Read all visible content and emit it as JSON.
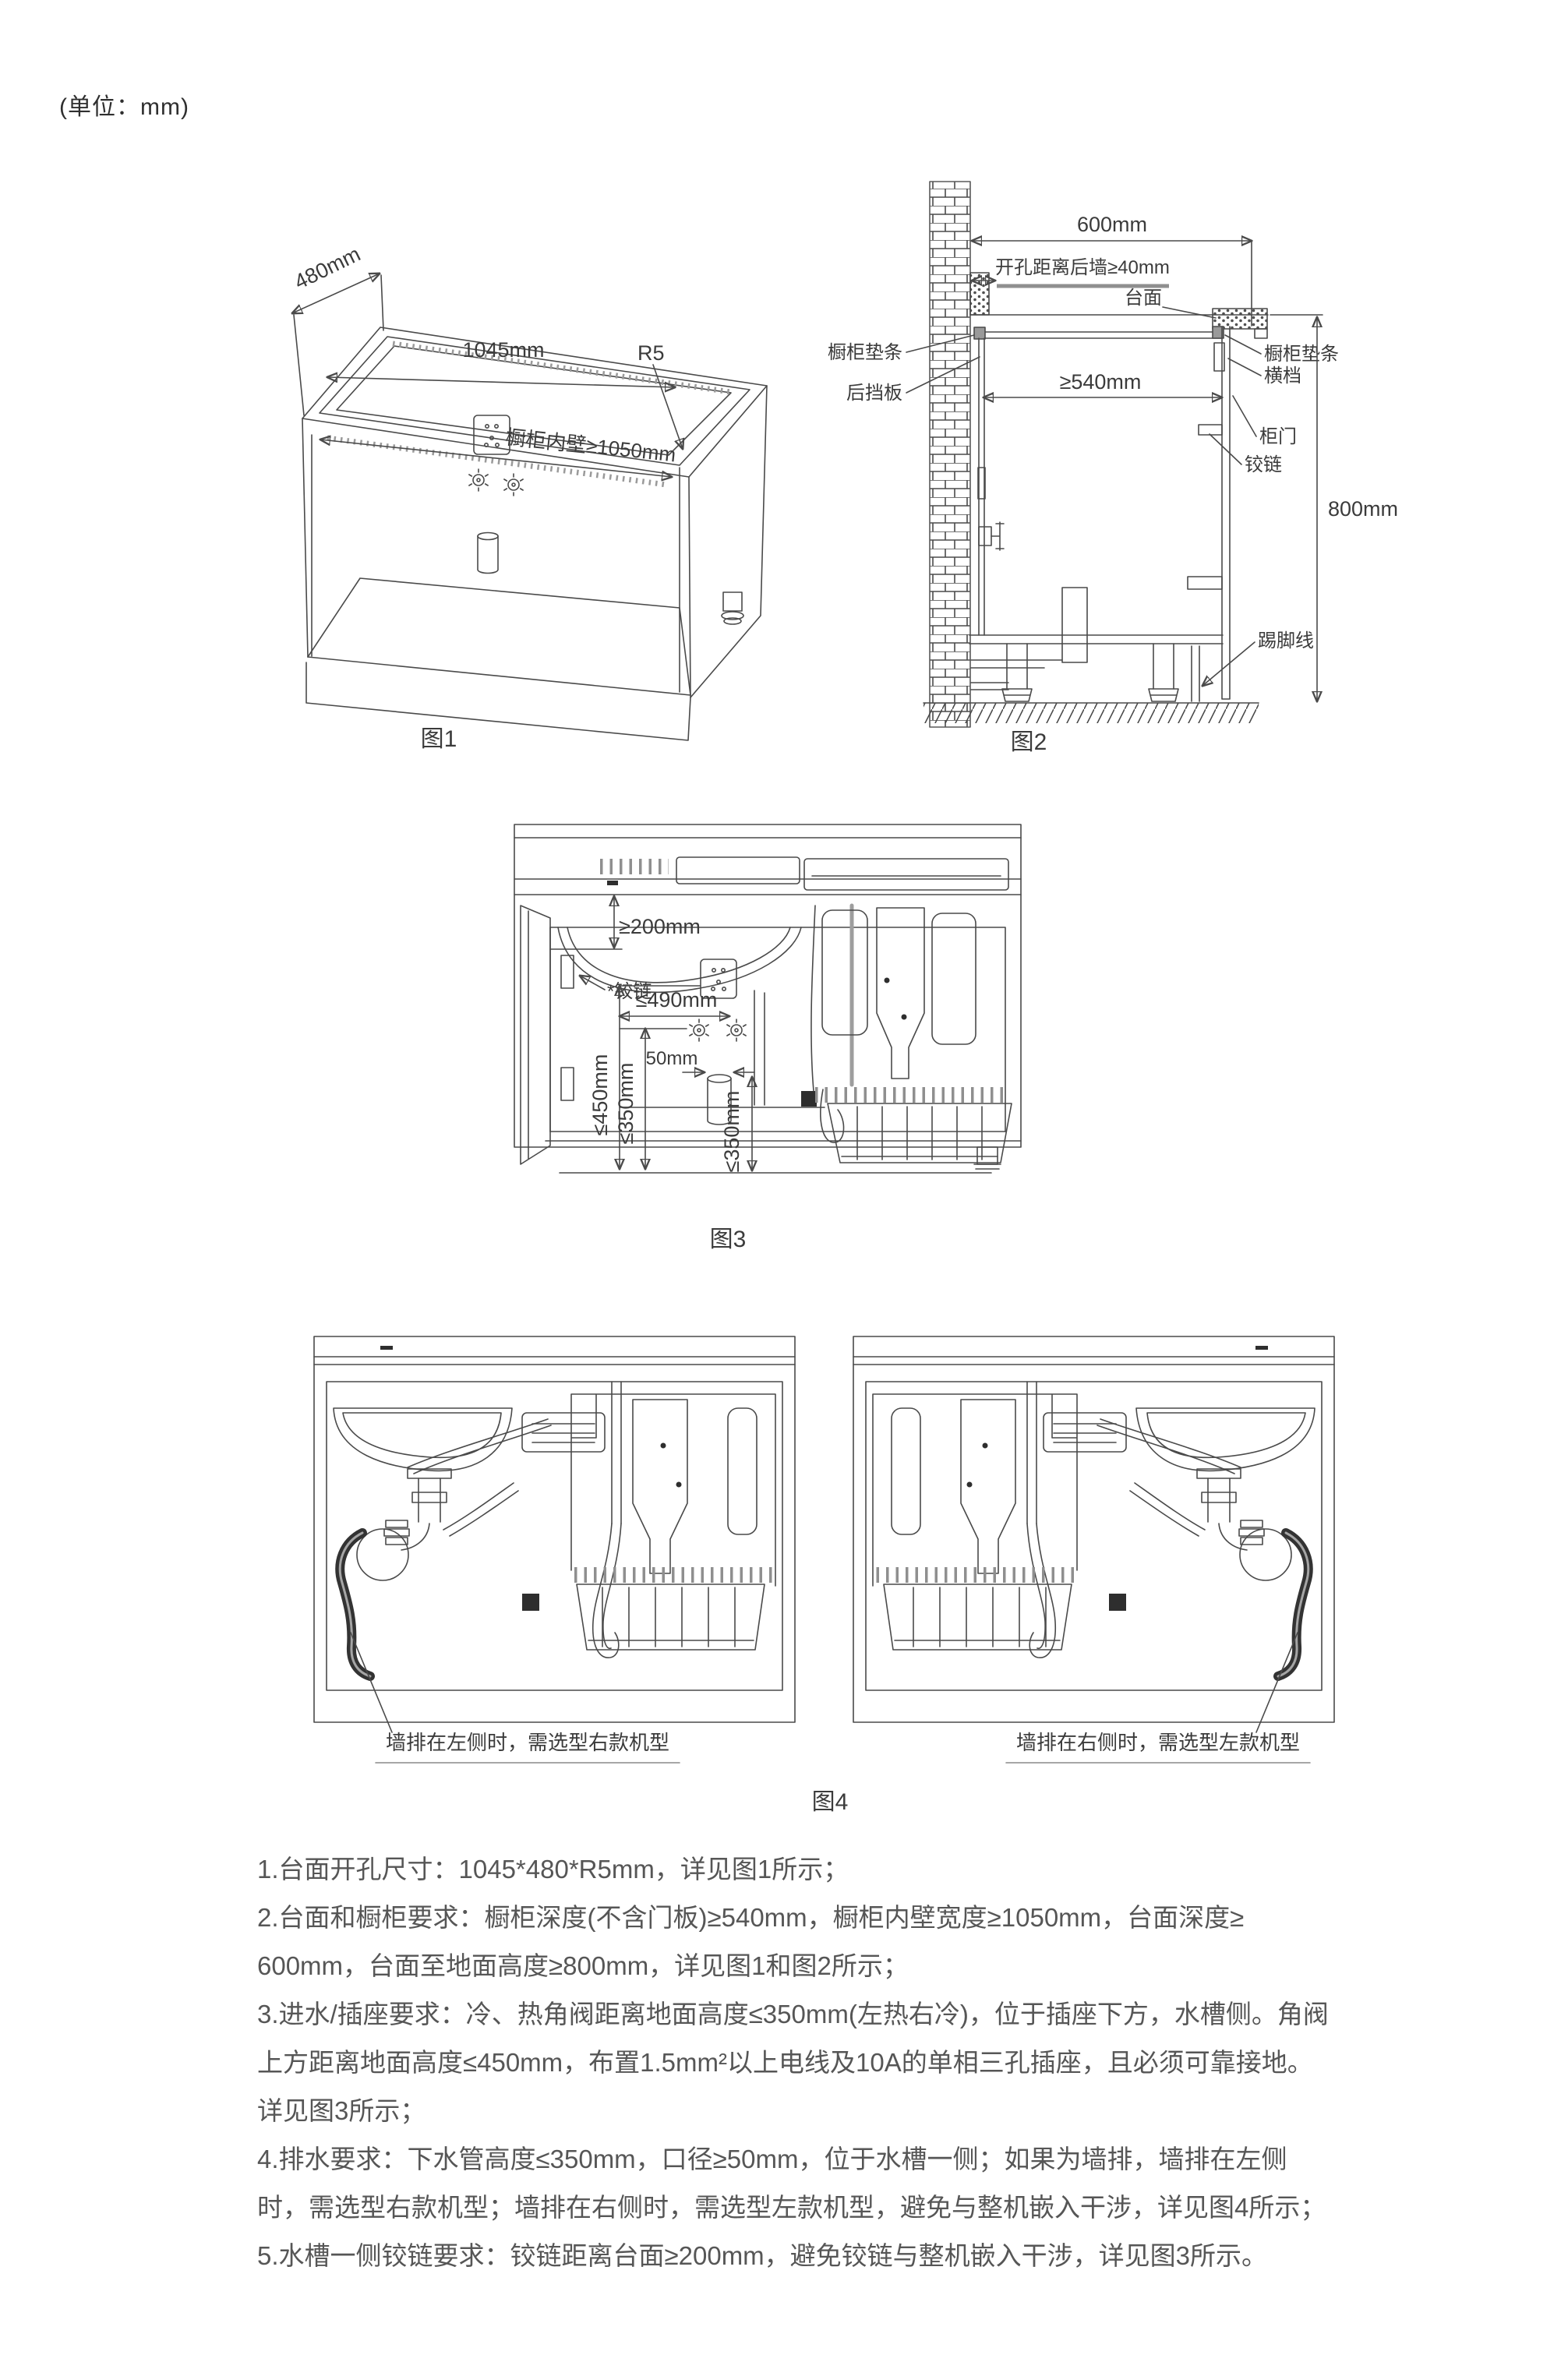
{
  "page": {
    "unit_note": "(单位：mm)"
  },
  "fig1": {
    "caption": "图1",
    "labels": {
      "depth": "480mm",
      "width": "1045mm",
      "radius": "R5",
      "inner_wall": "橱柜内壁≥1050mm"
    }
  },
  "fig2": {
    "caption": "图2",
    "labels": {
      "top_width": "600mm",
      "hole_to_wall": "开孔距离后墙≥40mm",
      "countertop": "台面",
      "pad_left": "橱柜垫条",
      "back_board": "后挡板",
      "inner_depth": "≥540mm",
      "pad_right": "橱柜垫条",
      "cross_rail": "横档",
      "door": "柜门",
      "hinge": "铰链",
      "height": "800mm",
      "kick_line": "踢脚线"
    }
  },
  "fig3": {
    "caption": "图3",
    "labels": {
      "hinge_gap": "≥200mm",
      "hinge": "*铰链",
      "valve_width": "≤490mm",
      "pipe_width": "50mm",
      "valve_top_height": "≤450mm",
      "valve_height": "≤350mm",
      "drain_height": "≤350mm"
    }
  },
  "fig4": {
    "caption": "图4",
    "left_caption": "墙排在左侧时，需选型右款机型",
    "right_caption": "墙排在右侧时，需选型左款机型"
  },
  "notes": {
    "lines": [
      "1.台面开孔尺寸：1045*480*R5mm，详见图1所示；",
      "2.台面和橱柜要求：橱柜深度(不含门板)≥540mm，橱柜内壁宽度≥1050mm，台面深度≥",
      "600mm，台面至地面高度≥800mm，详见图1和图2所示；",
      "3.进水/插座要求：冷、热角阀距离地面高度≤350mm(左热右冷)，位于插座下方，水槽侧。角阀",
      "上方距离地面高度≤450mm，布置1.5mm²以上电线及10A的单相三孔插座，且必须可靠接地。",
      "详见图3所示；",
      "4.排水要求：下水管高度≤350mm，口径≥50mm，位于水槽一侧；如果为墙排，墙排在左侧",
      "时，需选型右款机型；墙排在右侧时，需选型左款机型，避免与整机嵌入干涉，详见图4所示；",
      "5.水槽一侧铰链要求：铰链距离台面≥200mm，避免铰链与整机嵌入干涉，详见图3所示。"
    ]
  }
}
